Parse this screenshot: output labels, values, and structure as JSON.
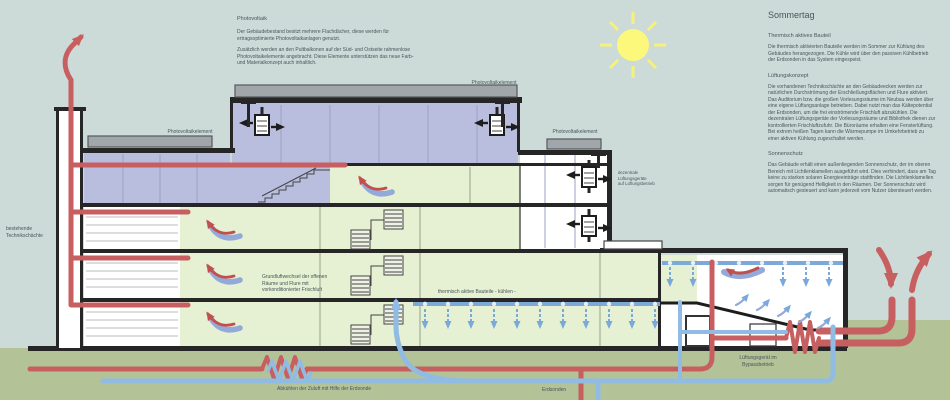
{
  "colors": {
    "sky": "#cddbd8",
    "ground": "#b4c397",
    "green": "#e6f0d2",
    "purple": "#b9bedf",
    "dark": "#262626",
    "red": "#c75f60",
    "red2": "#c0504d",
    "blue": "#90bce4",
    "blue2": "#79a9da",
    "ceil": "#7da9d9",
    "pv": "#a0a6a9",
    "sun": "#fbf87b",
    "text": "#46555a"
  },
  "photovoltaik_block": {
    "title": "Photovoltaik",
    "p1": "Der Gebäudebestand besitzt mehrere Flachdächer, diese werden für ertragsoptimierte Photovoltaikanlagen genutzt.",
    "p2": "Zusätzlich werden an den Pultbalkonen auf der Süd- und Ostseite rahmenlose Photovoltaikelemente angebracht. Diese Elemente unterstützen das neue Farb- und Materialkonzept auch inhaltlich."
  },
  "sommertag_block": {
    "title": "Sommertag",
    "sections": [
      {
        "heading": "Thermisch aktives Bauteil",
        "body": "Die thermisch aktivierten Bauteile werden im Sommer zur Kühlung des Gebäudes herangezogen. Die Kühle wird über den passiven Kühlbetrieb der Erdsonden in das System eingespeist."
      },
      {
        "heading": "Lüftungskonzept",
        "body": "Die vorhandenen Technikschächte an den Gebäudeecken werden zur natürlichen Durchströmung der Erschließungsflächen und Flure aktiviert. Das Auditorium bzw. die großen Vorlesungsräume im Neubau werden über eine eigene Lüftungsanlage betrieben. Dabei nutzt man das Kältepotential der Erdsonden, um die frei einströmende Frischluft abzukühlen. Die dezentralen Lüftungsgeräte der Vorlesungsräume und Bibliothek dienen zur kontrollierten Frischluftzufuhr. Die Büroräume erhalten eine Fensterlüftung. Bei extrem heißen Tagen kann die Wärmepumpe im Umkehrbetrieb zu einer aktiven Kühlung zugeschaltet werden."
      },
      {
        "heading": "Sonnenschutz",
        "body": "Das Gebäude erhält einen außenliegenden Sonnenschutz, der im oberen Bereich mit Lichtlenklamellen ausgeführt wird. Dies verhindert, dass am Tag keine zu starken solaren Energieeinträge stattfinden. Die Lichtlenklamellen sorgen für genügend Helligkeit in den Räumen. Der Sonnenschutz wird automatisch gesteuert und kann jederzeit vom Nutzer übersteuert werden."
      }
    ]
  },
  "diagram_labels": {
    "pv_element": "Photovoltaikelement",
    "technik": "bestehende\nTechnikschächte",
    "dezentral": "dezentrale\nLüftungsgeräte\nauf Lüftungsbetrieb",
    "grundluft": "Grundluftwechsel der offenen\nRäume und Flure mit\nvorkonditionierter Frischluft",
    "thermisch": "thermisch aktive Bauteile - kühlen -",
    "bypass": "Lüftungsgerät im\nBypassbetrieb",
    "abkuehlen": "Abkühlen der Zuluft mit Hilfe der Erdsonde",
    "erdsonden": "Erdsonden"
  }
}
